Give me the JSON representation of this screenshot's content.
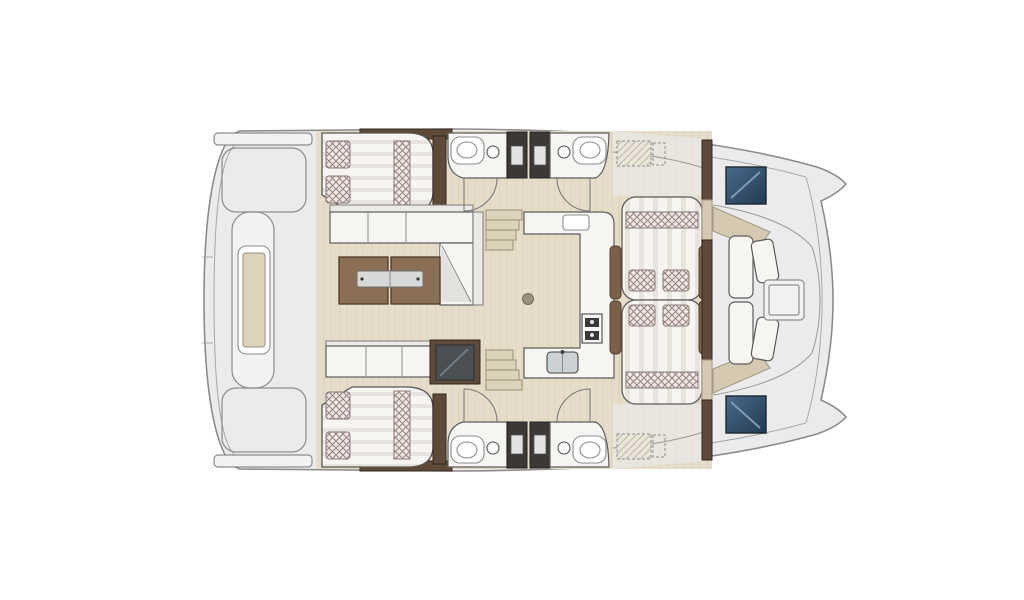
{
  "page": {
    "title": "",
    "kind": "catamaran-interior-floor-plan",
    "orientation": "bow-right"
  },
  "colors": {
    "background": "#ffffff",
    "deck": "#ebebeb",
    "deck_light": "#f2f2f1",
    "outline": "#8c8c8c",
    "outline_dark": "#4f4f4f",
    "wood_floor": "#e5ddc9",
    "wood_grain": "#d5cab0",
    "fixture_white": "#f6f5f2",
    "upholstery_stripe": "#e7e4dd",
    "cushion_base": "#efe9e6",
    "cushion_weave": "#9b8484",
    "table_wood": "#8a6f56",
    "cabinet_dark": "#5d4a39",
    "armrest_brown": "#7a6148",
    "metal": "#d8d8d8",
    "partition": "#3c3835",
    "hatch_blue_top": "#4a6a8c",
    "hatch_blue_bottom": "#233a50",
    "wedge_beige": "#d6c9b2",
    "step_beige": "#ddd2ba",
    "deck_hatch_line": "#bdb7aa"
  },
  "areas": [
    {
      "id": "stern-platform",
      "features": [
        "transom-bar",
        "step-platform",
        "dinghy-davit"
      ]
    },
    {
      "id": "port-aft-cabin",
      "features": [
        "double-bed",
        "pillows",
        "wardrobe"
      ]
    },
    {
      "id": "starboard-aft-cabin",
      "features": [
        "double-bed",
        "pillows",
        "wardrobe"
      ]
    },
    {
      "id": "salon",
      "features": [
        "l-sofa",
        "chaise",
        "folding-table",
        "bench",
        "tv-cabinet",
        "floor-hatch"
      ]
    },
    {
      "id": "galley",
      "features": [
        "l-counter",
        "stove",
        "double-sink"
      ]
    },
    {
      "id": "port-heads",
      "features": [
        "toilet",
        "sink",
        "shower-partition",
        "door"
      ]
    },
    {
      "id": "starboard-heads",
      "features": [
        "toilet",
        "sink",
        "shower-partition",
        "door"
      ]
    },
    {
      "id": "cockpit-dinette",
      "features": [
        "facing-seats",
        "cushions",
        "armrests"
      ]
    },
    {
      "id": "foredeck-lounge",
      "features": [
        "lounge-seats",
        "table",
        "deck-hatches"
      ]
    }
  ]
}
